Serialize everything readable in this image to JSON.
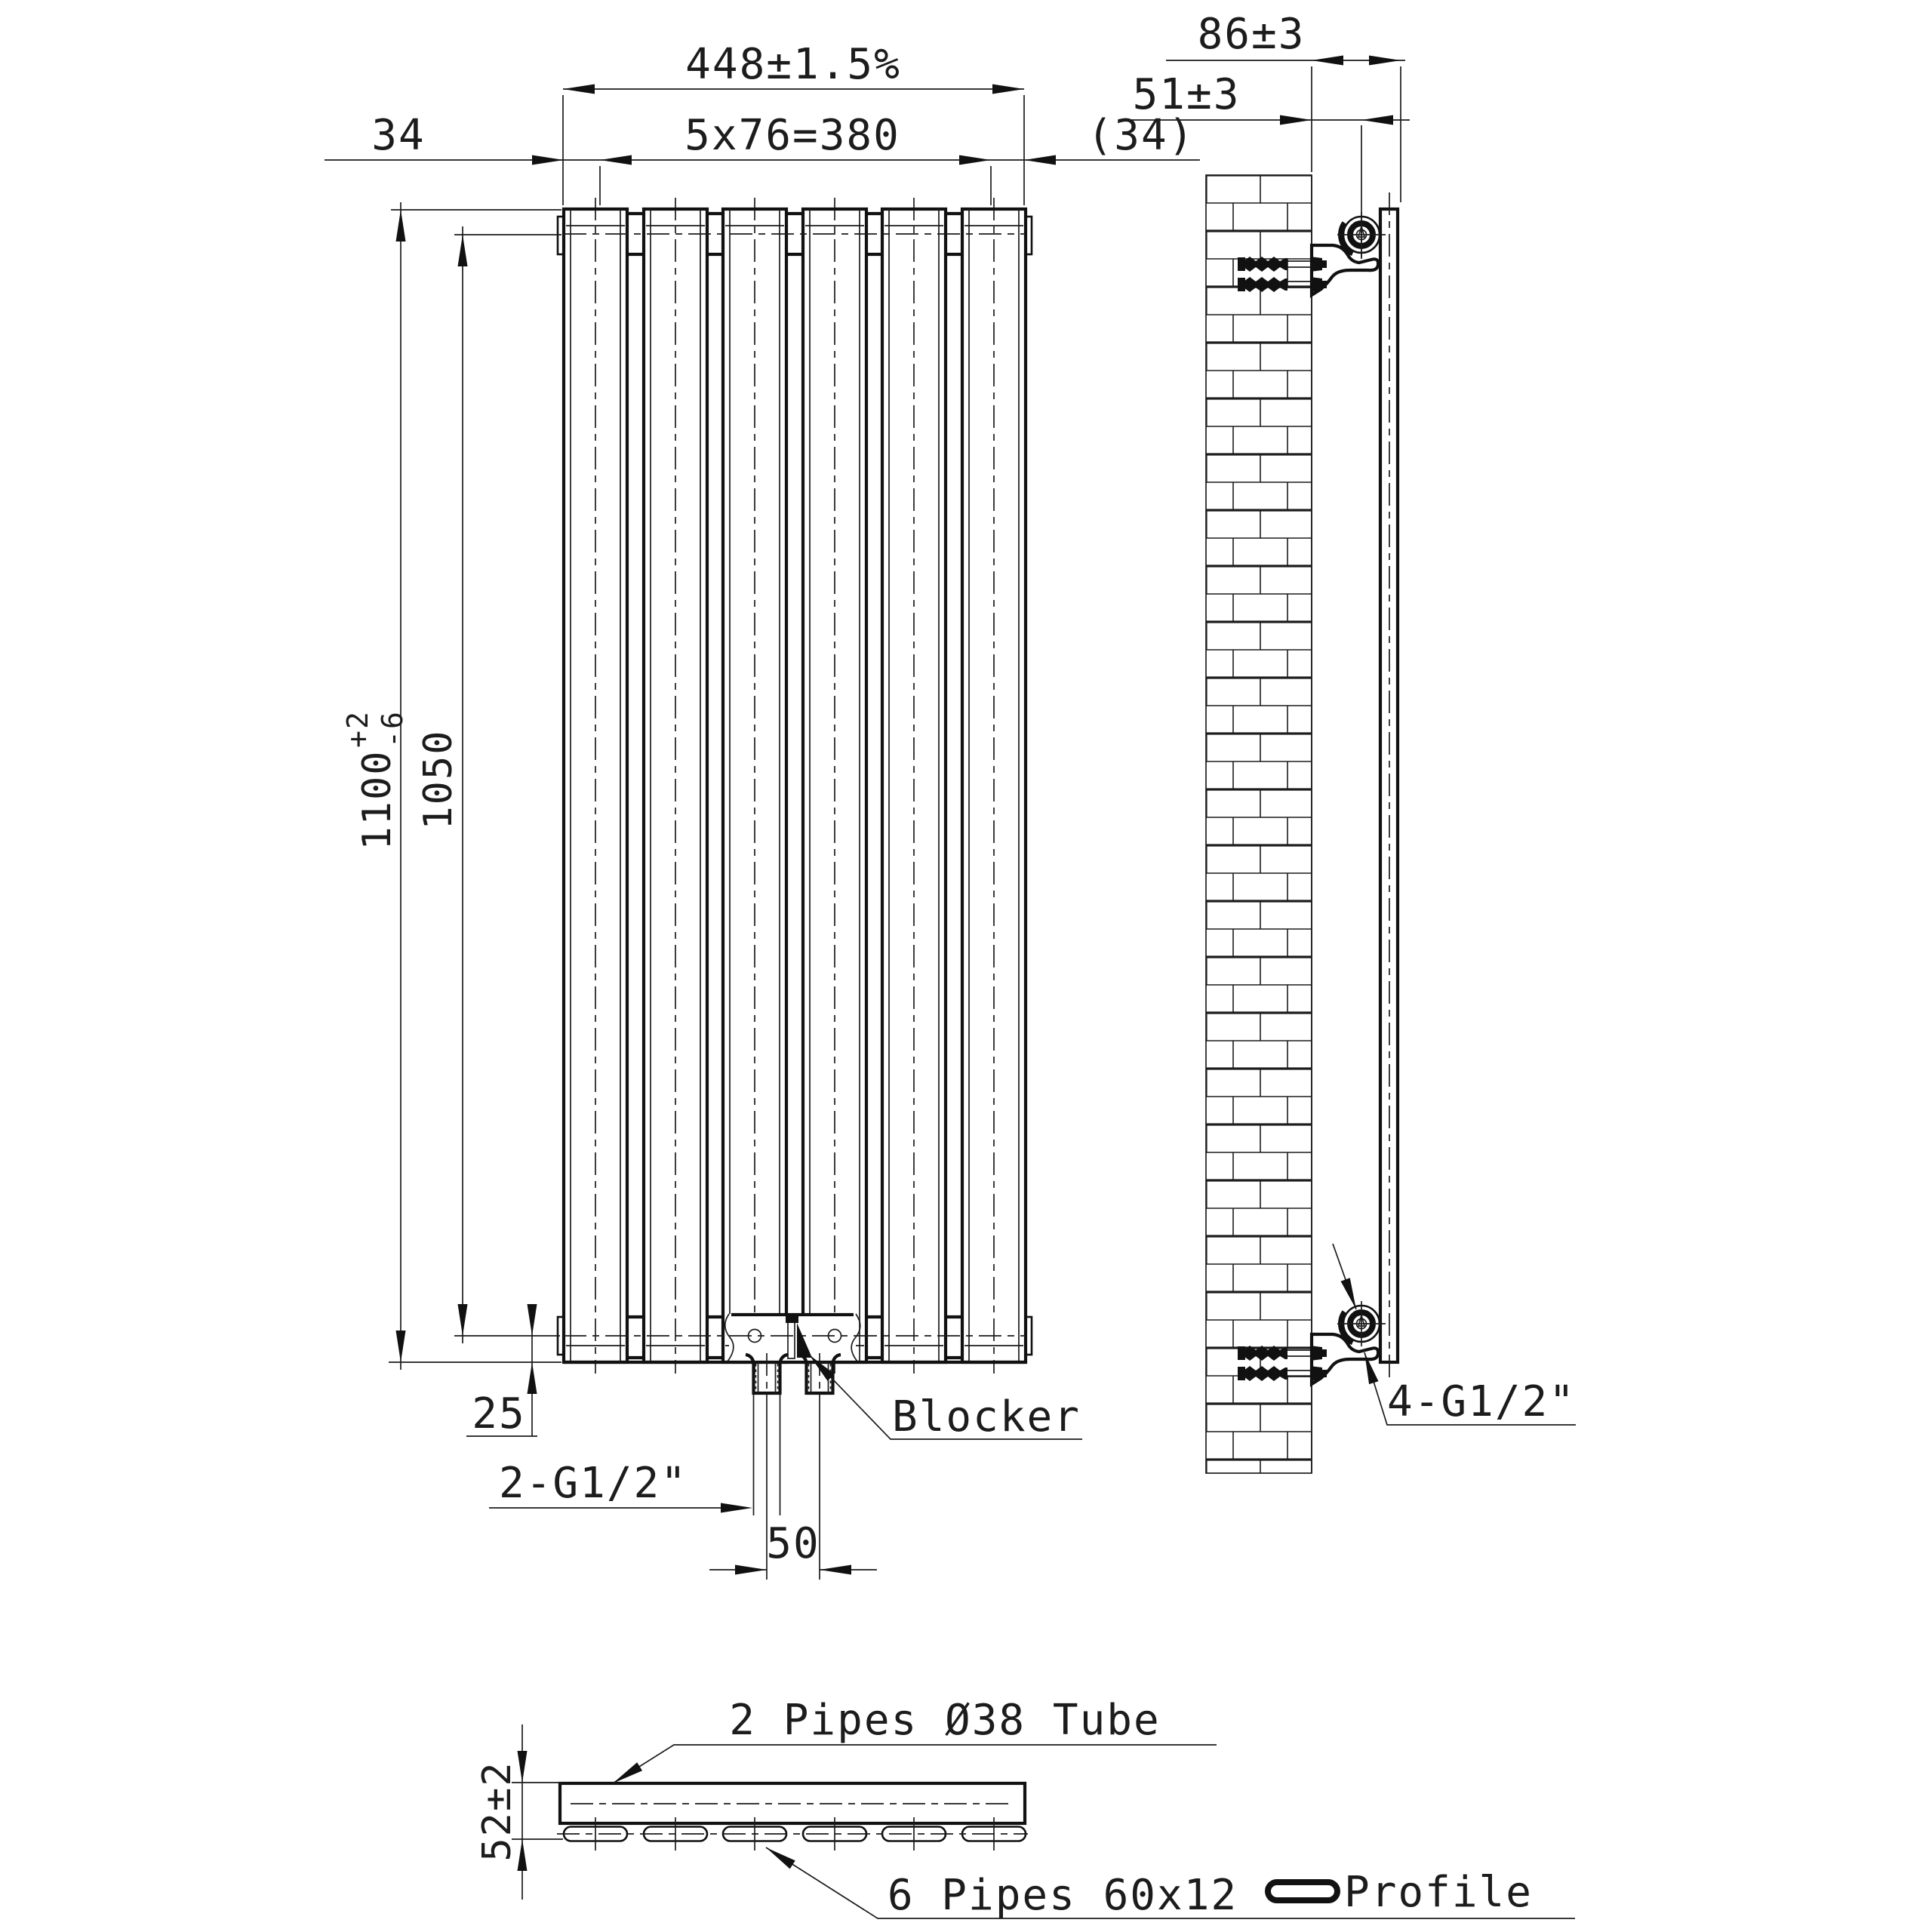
{
  "drawing": {
    "front_view": {
      "dim_overall_width": "448±1.5%",
      "dim_end_offset_left": "34",
      "dim_panel_pitch": "5x76=380",
      "dim_end_offset_right": "(34)",
      "dim_overall_height": {
        "main": "1100",
        "tol_plus": "+2",
        "tol_minus": "-6"
      },
      "dim_hub_distance": "1050",
      "dim_bottom_offset": "25",
      "dim_port_spacing": "50",
      "label_bottom_ports": "2-G1/2\"",
      "label_blocker": "Blocker"
    },
    "side_view": {
      "dim_depth_overall": "86±3",
      "dim_wall_to_tube": "51±3",
      "label_side_ports": "4-G1/2\""
    },
    "section_view": {
      "dim_depth_section": "52±2",
      "label_top_tubes": "2 Pipes Ø38 Tube",
      "label_bottom_pipes": "6 Pipes 60x12",
      "label_profile": "Profile"
    }
  }
}
